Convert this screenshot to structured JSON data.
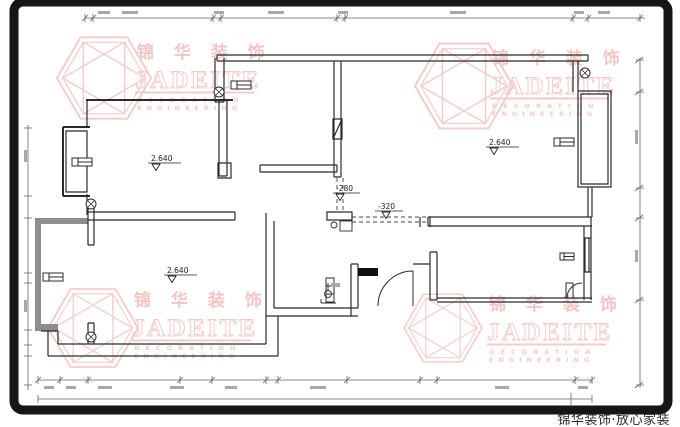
{
  "watermark": {
    "chinese": "锦 华 装 饰",
    "english": "JADEITE",
    "sub_line1": "DECORATION",
    "sub_line2": "ENGINEERING",
    "color": "#efaba7"
  },
  "elevation_labels": [
    "2.640",
    "2.640",
    "2.640",
    "-280",
    "-320"
  ],
  "footer": {
    "brand_tagline": "锦华装饰·放心家装"
  },
  "palette": {
    "background": "#ffffff",
    "frame": "#161616",
    "wall_line": "#2b2b2b",
    "dimension_line": "#666666",
    "watermark_pink": "#efaba7",
    "threshold_black": "#111111"
  }
}
